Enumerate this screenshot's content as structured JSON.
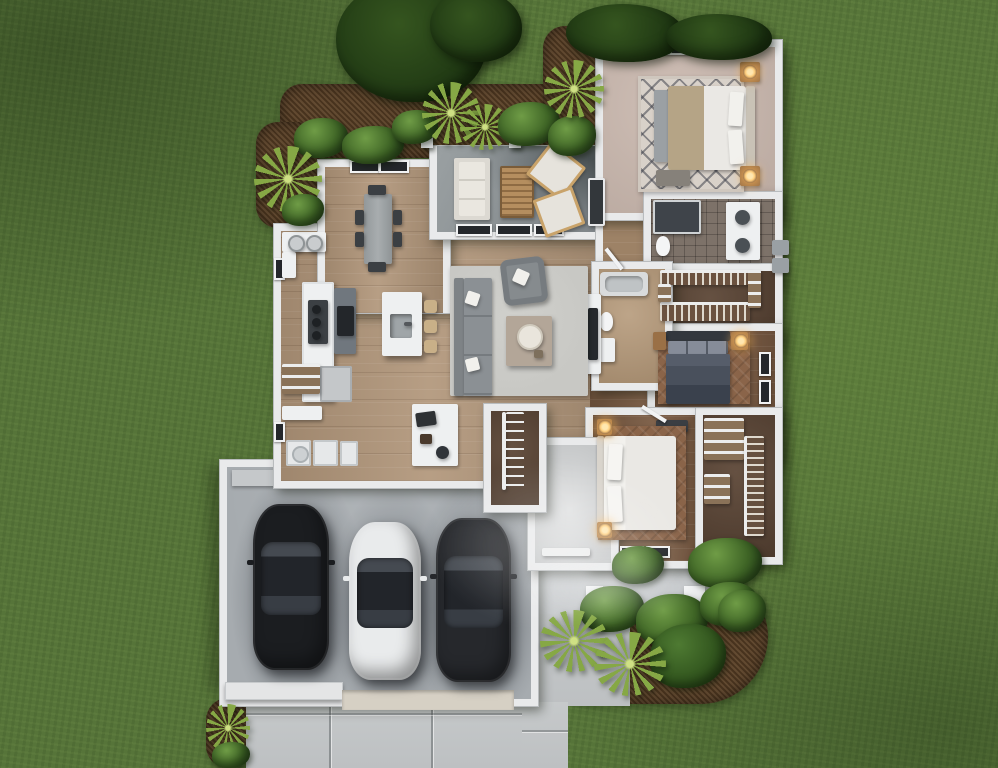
{
  "image_type": "3d-rendered-floor-plan",
  "view": "top-down dollhouse view of a single-story house on a lawn",
  "visible_text": [],
  "counts": {
    "bedrooms": 3,
    "bathrooms": 2,
    "garage_bays": 3,
    "cars": 3,
    "porch_columns": 2
  },
  "palette": {
    "grass": "#567439",
    "mulch": "#5a4026",
    "bush": "#3f6526",
    "bushLight": "#6f9c46",
    "bushDark": "#24401a",
    "palm": "#86a845",
    "wall": "#e9eaeb",
    "wallEdge": "#b9bcbe",
    "woodMain": "#b1967a",
    "woodDark": "#7a5b43",
    "woodHall": "#9d8266",
    "carpet": "#c9b7ad",
    "tile": "#7d7269",
    "closetFloor": "#5c4636",
    "concreteGarage": "#a6abaf",
    "concreteDrive": "#c6c9ca",
    "concretePatio": "#8d9294",
    "concretePorch": "#c9cccf",
    "rugLiving": "#c8c8c4",
    "rugMaster": "#d8d1c9",
    "rugBrown": "#8a6449",
    "sofaGray": "#8b9094",
    "bedWhite": "#eae8e4",
    "bedDark": "#49505c",
    "blanketTan": "#b5a486",
    "carBlack": "#1b1d20",
    "carWhite": "#e9ebec",
    "carGray": "#26282c",
    "glassDark": "#24272b",
    "stoolTan": "#c9b088",
    "lampGlow": "#ffcf7e",
    "fixtureWhite": "#eef0f1",
    "applianceGray": "#70777e",
    "woodFurn": "#9a7046",
    "tableGray": "#9fa4a6",
    "chairDark": "#3b3f43",
    "outdoorWood": "#b58e5f"
  },
  "scene": {
    "rooms": [
      {
        "name": "master-bedroom",
        "items": [
          "bed with tan blanket and white pillows",
          "trellis-pattern rug",
          "two nightstands with lit lamps",
          "foot bench",
          "accent stool",
          "three windows"
        ]
      },
      {
        "name": "master-bathroom",
        "items": [
          "walk-in shower",
          "water-closet toilet",
          "double-sink vanity"
        ]
      },
      {
        "name": "master-closet",
        "items": [
          "hanging rods with clothes",
          "shelving"
        ]
      },
      {
        "name": "bedroom-2",
        "items": [
          "dark upholstered bed",
          "patterned rug",
          "two wood nightstands",
          "lit lamp",
          "low dresser",
          "two windows"
        ]
      },
      {
        "name": "hall-bathroom",
        "items": [
          "bathtub",
          "toilet",
          "vanity"
        ]
      },
      {
        "name": "bedroom-3",
        "items": [
          "white bed",
          "brown rug",
          "two wood nightstands with lit lamps",
          "two windows"
        ]
      },
      {
        "name": "closet-3",
        "items": [
          "shelving unit",
          "hanging rod with clothes"
        ]
      },
      {
        "name": "living-room",
        "items": [
          "gray sectional sofa",
          "gray armchair",
          "area rug",
          "square coffee table with round tray",
          "white throw pillows",
          "media built-in"
        ]
      },
      {
        "name": "kitchen",
        "items": [
          "perimeter counter with cooktop",
          "appliance wall",
          "refrigerator",
          "island with sink",
          "three tan barstools",
          "pantry shelves"
        ]
      },
      {
        "name": "dining-room",
        "items": [
          "rectangular table",
          "six dark chairs",
          "two windows"
        ]
      },
      {
        "name": "bar-nook",
        "items": [
          "counter with two round sinks"
        ]
      },
      {
        "name": "laundry-mudroom",
        "items": [
          "bench",
          "washer",
          "dryer",
          "cabinet",
          "drop-zone counter with bags"
        ]
      },
      {
        "name": "entry-closet",
        "items": [
          "wire shelving"
        ]
      },
      {
        "name": "foyer",
        "items": [
          "front door"
        ]
      },
      {
        "name": "covered-patio",
        "items": [
          "white outdoor sofa",
          "slatted wood coffee table",
          "two angled lounge chairs",
          "dark wall panel",
          "two roof posts",
          "three window slots"
        ]
      },
      {
        "name": "garage",
        "items": [
          "entry step",
          "tire stains",
          "single door bay",
          "double door bay"
        ]
      }
    ],
    "vehicles": [
      {
        "name": "sedan-left",
        "color_key": "carBlack"
      },
      {
        "name": "sedan-middle",
        "color_key": "carWhite"
      },
      {
        "name": "sedan-right",
        "color_key": "carGray"
      }
    ],
    "hardscape": [
      "driveway with expansion joints",
      "front porch with two columns",
      "front walkway",
      "sidewalk"
    ],
    "landscaping": [
      "lawn",
      "mulch planting beds",
      "round shrubs",
      "dark canopy trees",
      "spiky palm/yucca plants"
    ],
    "exterior_equipment": [
      "two ac-units on right side"
    ]
  }
}
